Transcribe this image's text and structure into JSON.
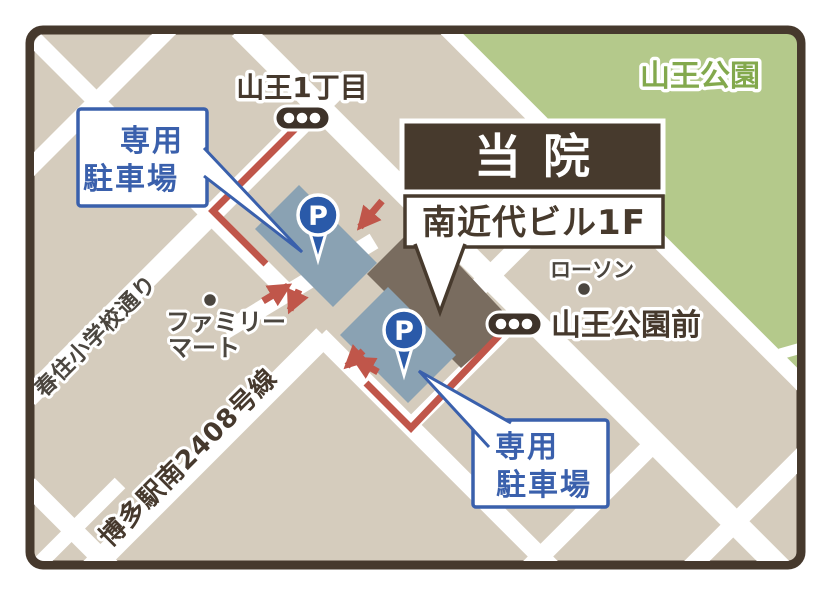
{
  "clinic": {
    "name": "当院",
    "building": "南近代ビル1F"
  },
  "park": {
    "name": "山王公園"
  },
  "bus_stops": {
    "stop1": "山王1丁目",
    "stop2": "山王公園前"
  },
  "parking": {
    "label_line1": "専用",
    "label_line2": "駐車場",
    "pin_letter": "P"
  },
  "stores": {
    "lawson": "ローソン",
    "familymart_line1": "ファミリー",
    "familymart_line2": "マート"
  },
  "streets": {
    "harusumi": "春住小学校通り",
    "route2408": "博多駅南2408号線"
  },
  "colors": {
    "map_bg": "#d5ccbd",
    "road_white": "#ffffff",
    "border_brown": "#46392d",
    "park_green": "#b4c98b",
    "park_text_green": "#83a94d",
    "parking_lot_gray": "#8aa2b3",
    "building_taupe": "#796c5f",
    "route_red": "#c0564a",
    "pin_blue": "#2a5aa9",
    "bubble_blue": "#3a60ac",
    "bus_pill_brown": "#3e332a",
    "store_text": "#4b463f"
  }
}
